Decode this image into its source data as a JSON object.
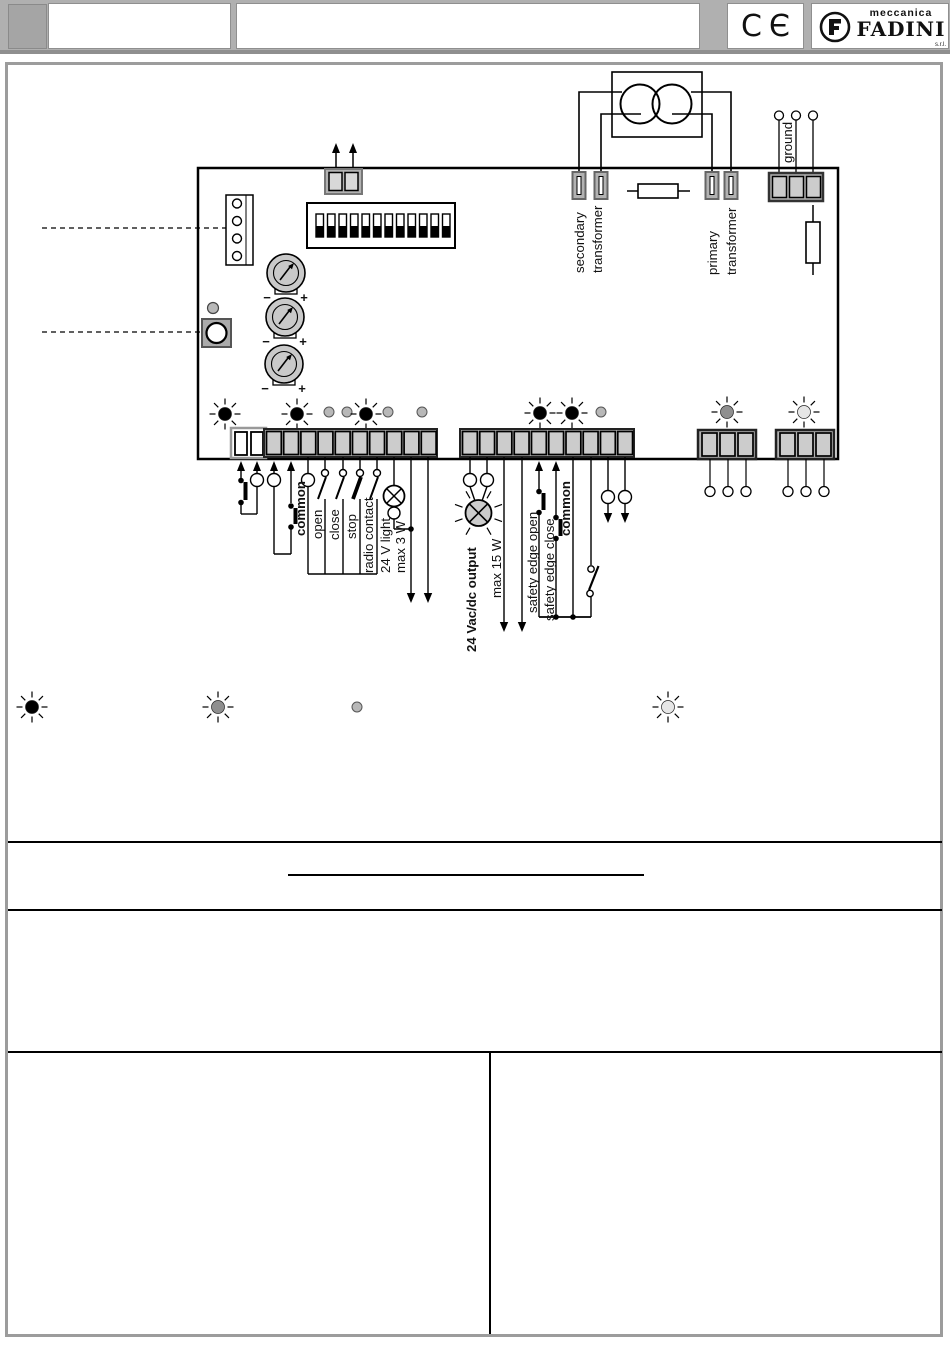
{
  "header": {
    "ce_mark": "CЄ",
    "logo": {
      "line1": "meccanica",
      "line2": "FADINI",
      "suffix": "s.r.l."
    }
  },
  "diagram": {
    "labels": {
      "secondary_transformer_line1": "secondary",
      "secondary_transformer_line2": "transformer",
      "primary_transformer_line1": "primary",
      "primary_transformer_line2": "transformer",
      "ground": "ground",
      "common_left": "common",
      "open": "open",
      "close": "close",
      "stop": "stop",
      "radio_contact": "radio contact",
      "light_24v": "24 V light",
      "max_3w": "max 3 W",
      "output_24v": "24 Vac/dc output",
      "max_15w": "max 15 W",
      "safety_edge_open": "safety edge open",
      "safety_edge_close": "safety edge close",
      "common_mid": "common",
      "trimmer_minus": "−",
      "trimmer_plus": "+"
    }
  },
  "colors": {
    "header_bg": "#b0b0b0",
    "panel_border": "#9c9c9c",
    "terminal_gray": "#c9c9c9",
    "block_gray": "#b2b2b2",
    "led_on_black": "#000000",
    "led_gray": "#8f8f8f",
    "led_light": "#e6e6e6",
    "led_plain": "#b8b8b8",
    "line_black": "#000000"
  }
}
